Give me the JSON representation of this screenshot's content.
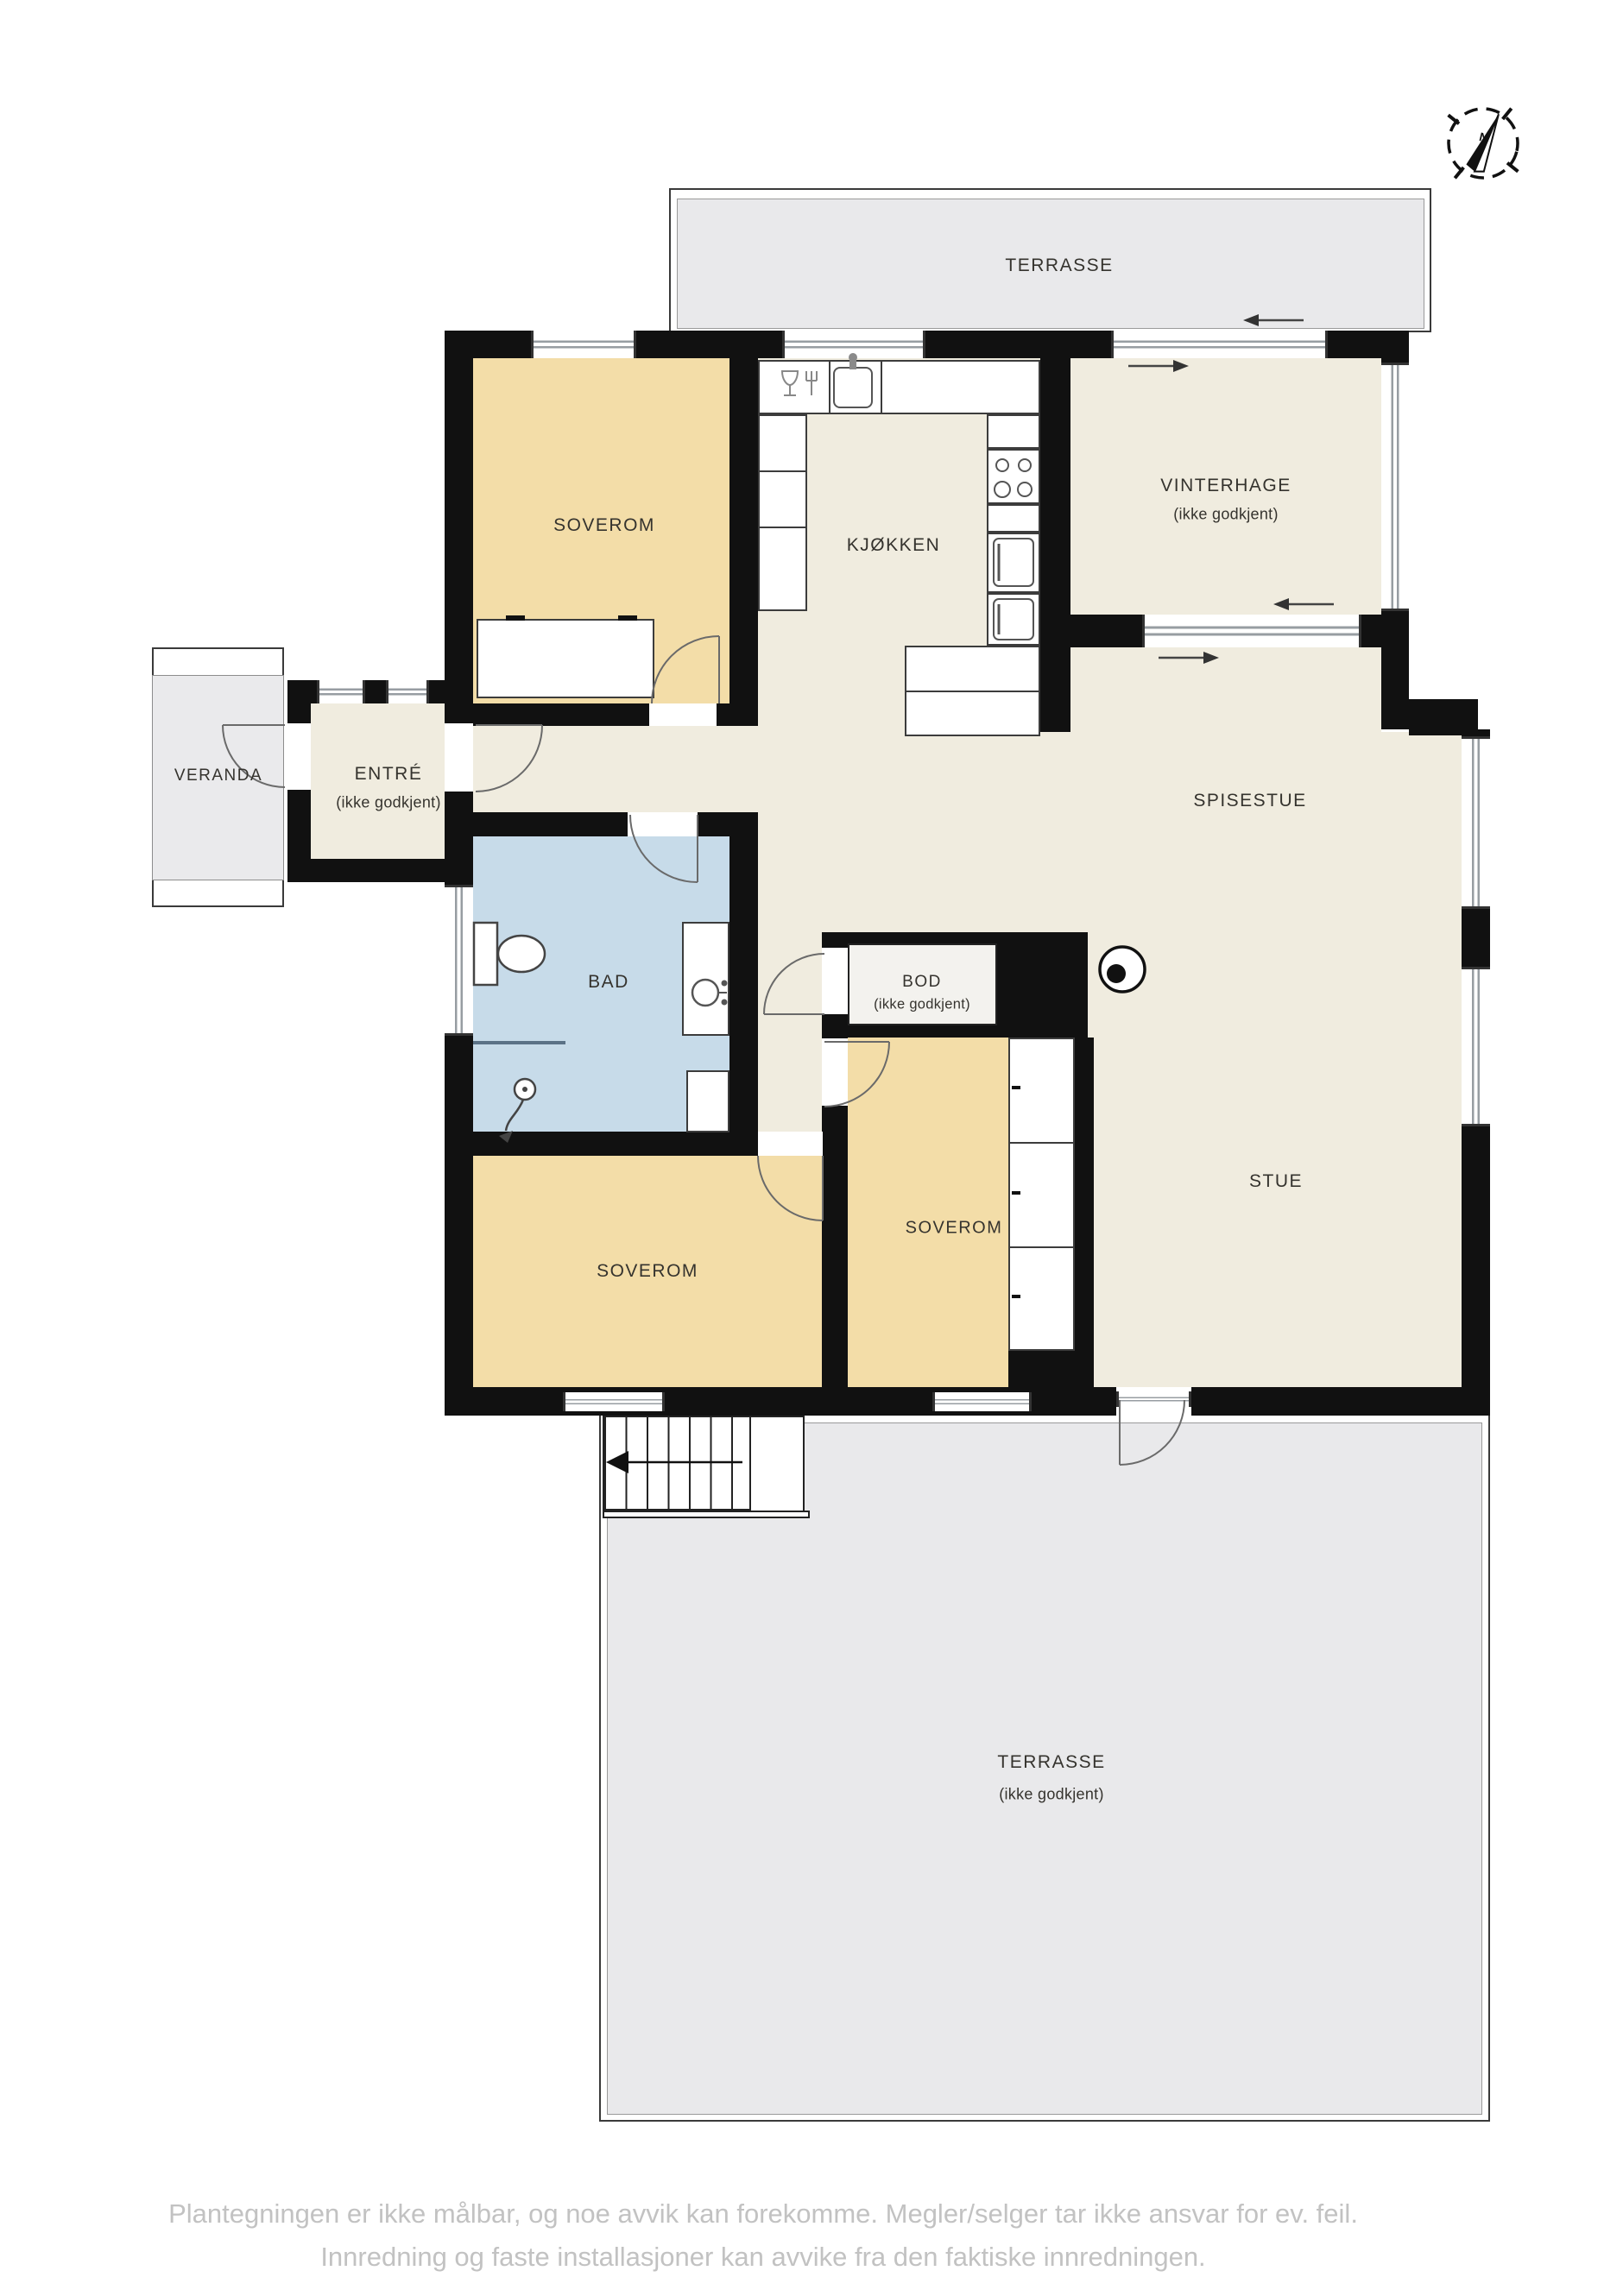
{
  "compass": {
    "letter": "N"
  },
  "rooms": {
    "terrasse_top": {
      "label": "TERRASSE"
    },
    "soverom_tl": {
      "label": "SOVEROM"
    },
    "kjokken": {
      "label": "KJØKKEN"
    },
    "vinterhage": {
      "label": "VINTERHAGE",
      "sublabel": "(ikke godkjent)"
    },
    "veranda": {
      "label": "VERANDA"
    },
    "entre": {
      "label": "ENTRÉ",
      "sublabel": "(ikke godkjent)"
    },
    "spisestue": {
      "label": "SPISESTUE"
    },
    "bad": {
      "label": "BAD"
    },
    "bod": {
      "label": "BOD",
      "sublabel": "(ikke godkjent)"
    },
    "soverom_mid": {
      "label": "SOVEROM"
    },
    "soverom_bl": {
      "label": "SOVEROM"
    },
    "stue": {
      "label": "STUE"
    },
    "terrasse_bottom": {
      "label": "TERRASSE",
      "sublabel": "(ikke godkjent)"
    }
  },
  "footer": {
    "line1": "Plantegningen er ikke målbar, og noe avvik kan forekomme. Megler/selger tar ikke ansvar for ev. feil.",
    "line2": "Innredning og faste installasjoner kan avvike fra den faktiske innredningen."
  },
  "colors": {
    "wall": "#111111",
    "floor_cream": "#f0ecdf",
    "bedroom_beige": "#f3dda8",
    "bath_blue": "#c7dbe9",
    "terrace_gray": "#e9e9eb",
    "storage_gray": "#f3f2ee",
    "label": "#35332e",
    "footer_gray": "#c2c2c2"
  }
}
